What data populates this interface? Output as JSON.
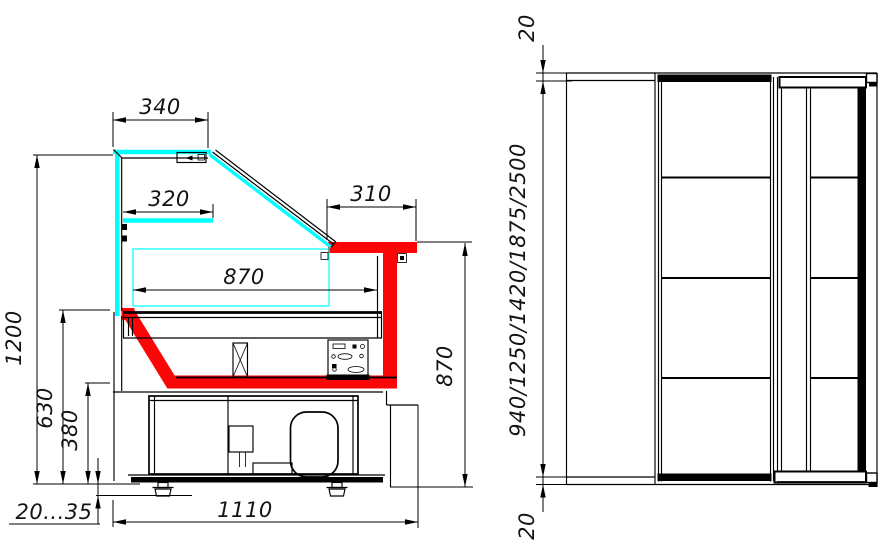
{
  "drawing": {
    "colors": {
      "line": "#000000",
      "glass": "#00ffff",
      "highlighted_surface": "#fb0606",
      "background": "#ffffff"
    },
    "side_view": {
      "dims": {
        "canopy_width": "340",
        "shelf_width": "320",
        "countertop_depth": "310",
        "deck_length": "870",
        "overall_height": "1200",
        "deck_height": "630",
        "bowl_height": "380",
        "leg_adjustment": "20...35",
        "base_depth": "1110",
        "counter_height": "870"
      }
    },
    "plan_view": {
      "dims": {
        "top_overhang": "20",
        "case_lengths": "940/1250/1420/1875/2500",
        "bottom_overhang": "20"
      }
    }
  }
}
